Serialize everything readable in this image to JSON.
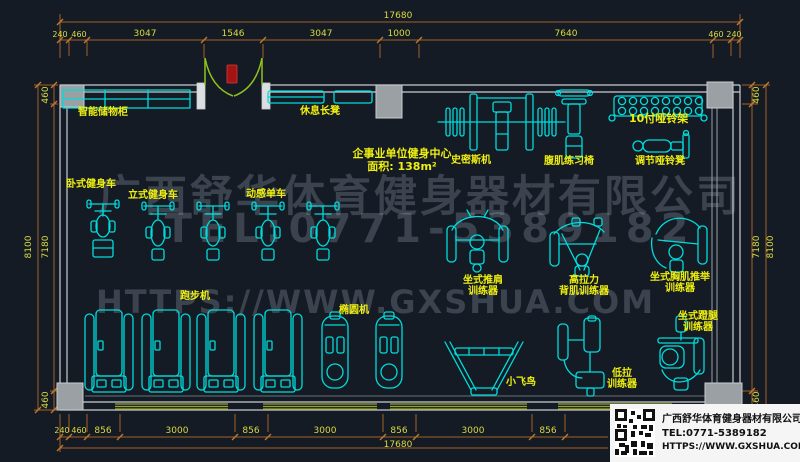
{
  "room": {
    "title": "企事业单位健身中心",
    "area": "面积: 138m²"
  },
  "labels": {
    "locker": "智能储物柜",
    "rest_bench": "休息长凳",
    "recumbent_bike": "卧式健身车",
    "upright_bike": "立式健身车",
    "spin_bike": "动感单车",
    "treadmill": "跑步机",
    "elliptical": "椭圆机",
    "smith_machine": "史密斯机",
    "ab_bench": "腹肌练习椅",
    "dumbbell_rack": "10付哑铃架",
    "adjustable_bench": "调节哑铃凳",
    "shoulder_press_l1": "坐式推肩",
    "shoulder_press_l2": "训练器",
    "lat_pulldown_l1": "高拉力",
    "lat_pulldown_l2": "背肌训练器",
    "chest_press_l1": "坐式胸肌推举",
    "chest_press_l2": "训练器",
    "leg_press_l1": "坐式蹬腿",
    "leg_press_l2": "训练器",
    "fly_bird": "小飞鸟",
    "low_row_l1": "低拉",
    "low_row_l2": "训练器"
  },
  "dimensions": {
    "top_overall": "17680",
    "top_segments": [
      "240",
      "460",
      "3047",
      "1546",
      "3047",
      "1000",
      "7640",
      "460",
      "240"
    ],
    "bottom_overall": "17680",
    "bottom_segments": [
      "240",
      "460",
      "856",
      "3000",
      "856",
      "3000",
      "856",
      "3000",
      "856"
    ],
    "left_overall": "8100",
    "left_segments": [
      "460",
      "7180",
      "460"
    ],
    "right_overall": "8100",
    "right_segments": [
      "460",
      "7180",
      "460"
    ]
  },
  "watermark": {
    "line1": "广西舒华体育健身器材有限公司",
    "line2": "TEL:0771-5389182",
    "line3": "HTTPS://WWW.GXSHUA.COM"
  },
  "title_block": {
    "company": "广西舒华体育健身器材有限公司",
    "tel": "TEL:0771-5389182",
    "url": "HTTPS://WWW.GXSHUA.COM"
  },
  "colors": {
    "background": "#141b24",
    "equipment": "#00dcdc",
    "label_text": "#efef10",
    "dimension_line": "#a5612a",
    "dimension_text": "#d9da3e",
    "wall": "#c7ccd1",
    "door": "#8fc31f",
    "door_marker": "#a51212",
    "window_strip": "#97a52c",
    "watermark": "#4a5260"
  }
}
